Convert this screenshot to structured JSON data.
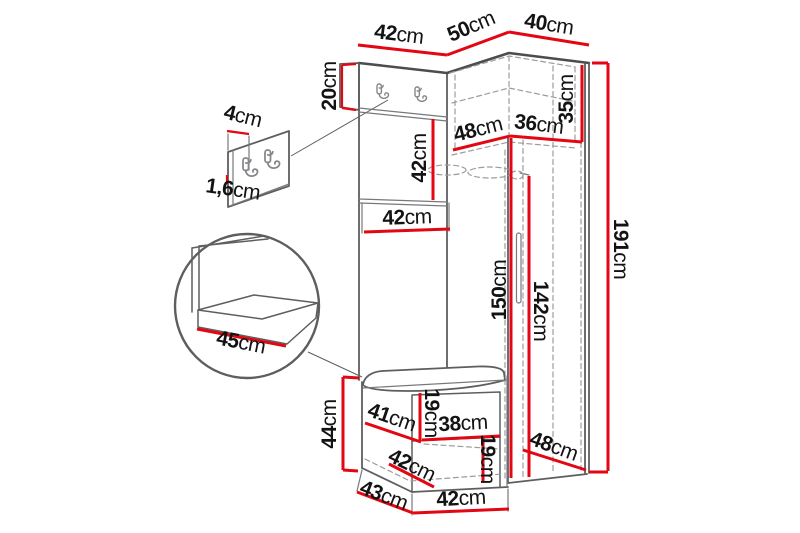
{
  "diagram": {
    "type": "furniture-dimension-drawing",
    "subject": "hallway set: coat-hook panel, corner wardrobe and shoe bench with magnified seat and hook-board details",
    "colors": {
      "dimension_line": "#e30613",
      "outline": "#5d5e60",
      "hidden_edge": "#9b9c9e",
      "label_text": "#131313",
      "background": "#ffffff"
    },
    "icons": {
      "coat_hook": "coat-hook-icon",
      "door_handle": "door-handle-icon",
      "magnifier": "magnifier-circle-detail"
    },
    "dims": {
      "top_width": {
        "value": "42",
        "unit": "cm"
      },
      "depth_top": {
        "value": "50",
        "unit": "cm"
      },
      "wardrobe_width": {
        "value": "40",
        "unit": "cm"
      },
      "hook_board_height": {
        "value": "20",
        "unit": "cm"
      },
      "panel_height": {
        "value": "42",
        "unit": "cm"
      },
      "panel_width": {
        "value": "42",
        "unit": "cm"
      },
      "hook_spacing": {
        "value": "4",
        "unit": "cm"
      },
      "board_thickness": {
        "value": "1,6",
        "unit": "cm"
      },
      "corner_left_depth": {
        "value": "48",
        "unit": "cm"
      },
      "corner_right_width": {
        "value": "36",
        "unit": "cm"
      },
      "top_shelf_height": {
        "value": "35",
        "unit": "cm"
      },
      "total_height": {
        "value": "191",
        "unit": "cm"
      },
      "rail_height": {
        "value": "150",
        "unit": "cm"
      },
      "door_height": {
        "value": "142",
        "unit": "cm"
      },
      "seat_depth": {
        "value": "45",
        "unit": "cm"
      },
      "bench_height": {
        "value": "44",
        "unit": "cm"
      },
      "bench_left_width": {
        "value": "41",
        "unit": "cm"
      },
      "upper_gap": {
        "value": "19",
        "unit": "cm"
      },
      "shelf_width": {
        "value": "38",
        "unit": "cm"
      },
      "bench_mid_width": {
        "value": "42",
        "unit": "cm"
      },
      "lower_gap": {
        "value": "19",
        "unit": "cm"
      },
      "bottom_depth": {
        "value": "48",
        "unit": "cm"
      },
      "bench_bottom_side": {
        "value": "43",
        "unit": "cm"
      },
      "bench_bottom_width": {
        "value": "42",
        "unit": "cm"
      }
    }
  }
}
